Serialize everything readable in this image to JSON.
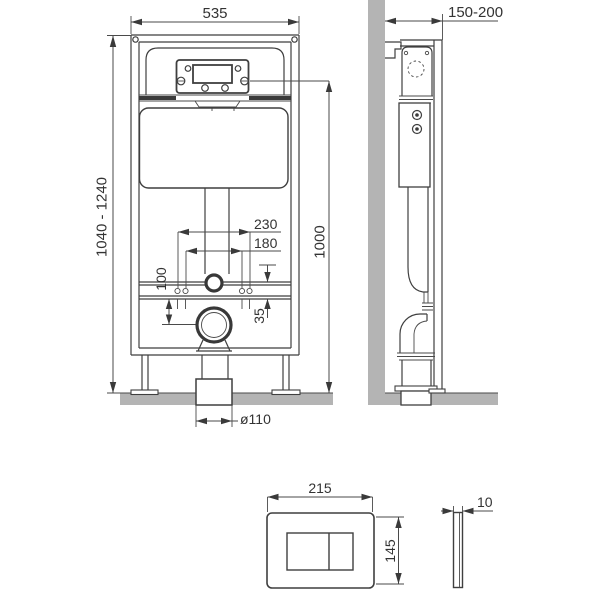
{
  "drawing": {
    "type": "technical-installation-diagram",
    "dimensions": {
      "frame_width": "535",
      "frame_height_range": "1040 - 1240",
      "install_height": "1000",
      "depth_range": "150-200",
      "fixing_outer": "230",
      "fixing_inner": "180",
      "outlet_offset": "100",
      "rail_offset": "35",
      "drain_diameter": "ø110",
      "plate_width": "215",
      "plate_height": "145",
      "plate_thickness": "10"
    },
    "colors": {
      "line": "#3f3f3f",
      "dimension_line": "#4a4a4a",
      "text": "#333333",
      "masonry_gray": "#b4b4b4",
      "background": "#ffffff"
    }
  }
}
